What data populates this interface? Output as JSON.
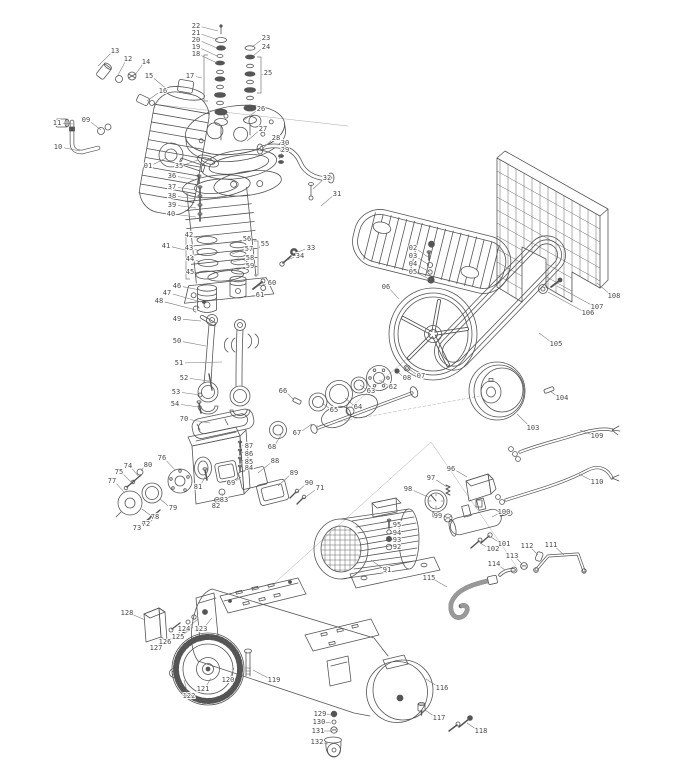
{
  "page": {
    "background": "#ffffff"
  },
  "diagram": {
    "type": "exploded-parts-diagram",
    "subject": "belt-drive air compressor: pump head, cylinder, pistons, crankcase, flywheel, belt, belt guard, motor, pressure switch, gauge, air tank, wheels",
    "style": {
      "line_color": "#555555",
      "label_color": "#4a4a4a",
      "leader_color": "#777777",
      "background": "#ffffff"
    },
    "label_range": "01-132",
    "components": [
      "air-filter-silencer",
      "valve-stacks",
      "cylinder-head",
      "exhaust-tube",
      "cooling-shroud",
      "cylinder",
      "piston-rings",
      "pistons",
      "connecting-rods",
      "crankcase",
      "bearing-covers",
      "crankshaft",
      "bearings",
      "flywheel",
      "drive-belt",
      "belt-guard",
      "motor-pulley",
      "electric-motor",
      "pressure-switch",
      "pressure-gauge",
      "outlet-manifold",
      "pipes",
      "hose",
      "wires",
      "air-tank",
      "wheel",
      "caster"
    ],
    "parts": [
      {
        "n": "01",
        "x": 148,
        "y": 166,
        "tx": 166,
        "ty": 158
      },
      {
        "n": "02",
        "x": 413,
        "y": 248,
        "tx": 428,
        "ty": 257
      },
      {
        "n": "03",
        "x": 413,
        "y": 256,
        "tx": 429,
        "ty": 265
      },
      {
        "n": "04",
        "x": 413,
        "y": 264,
        "tx": 430,
        "ty": 272
      },
      {
        "n": "05",
        "x": 413,
        "y": 272,
        "tx": 431,
        "ty": 280
      },
      {
        "n": "06",
        "x": 386,
        "y": 287,
        "tx": 399,
        "ty": 299
      },
      {
        "n": "07",
        "x": 421,
        "y": 376,
        "tx": 409,
        "ty": 369
      },
      {
        "n": "08",
        "x": 407,
        "y": 378,
        "tx": 398,
        "ty": 372
      },
      {
        "n": "09",
        "x": 86,
        "y": 120,
        "tx": 101,
        "ty": 130
      },
      {
        "n": "10",
        "x": 58,
        "y": 147,
        "tx": 80,
        "ty": 151
      },
      {
        "n": "11",
        "x": 57,
        "y": 123,
        "tx": 73,
        "ty": 124
      },
      {
        "n": "12",
        "x": 128,
        "y": 59,
        "tx": 117,
        "ty": 77
      },
      {
        "n": "13",
        "x": 115,
        "y": 51,
        "tx": 98,
        "ty": 66
      },
      {
        "n": "14",
        "x": 146,
        "y": 62,
        "tx": 135,
        "ty": 75
      },
      {
        "n": "15",
        "x": 149,
        "y": 76,
        "tx": 168,
        "ty": 90
      },
      {
        "n": "16",
        "x": 163,
        "y": 91,
        "tx": 147,
        "ty": 101
      },
      {
        "n": "17",
        "x": 190,
        "y": 76,
        "tx": 202,
        "ty": 78
      },
      {
        "n": "18",
        "x": 196,
        "y": 54,
        "tx": 217,
        "ty": 63
      },
      {
        "n": "19",
        "x": 196,
        "y": 47,
        "tx": 217,
        "ty": 56
      },
      {
        "n": "20",
        "x": 196,
        "y": 40,
        "tx": 217,
        "ty": 48
      },
      {
        "n": "21",
        "x": 196,
        "y": 33,
        "tx": 218,
        "ty": 40
      },
      {
        "n": "22",
        "x": 196,
        "y": 26,
        "tx": 218,
        "ty": 31
      },
      {
        "n": "23",
        "x": 266,
        "y": 38,
        "tx": 252,
        "ty": 47
      },
      {
        "n": "24",
        "x": 266,
        "y": 47,
        "tx": 253,
        "ty": 56
      },
      {
        "n": "25",
        "x": 268,
        "y": 73,
        "tx": 262,
        "ty": 75
      },
      {
        "n": "26",
        "x": 261,
        "y": 109,
        "tx": 244,
        "ty": 120
      },
      {
        "n": "27",
        "x": 263,
        "y": 129,
        "tx": 247,
        "ty": 141
      },
      {
        "n": "28",
        "x": 276,
        "y": 138,
        "tx": 261,
        "ty": 150
      },
      {
        "n": "29",
        "x": 285,
        "y": 150,
        "tx": 279,
        "ty": 159
      },
      {
        "n": "30",
        "x": 285,
        "y": 143,
        "tx": 280,
        "ty": 152
      },
      {
        "n": "31",
        "x": 337,
        "y": 194,
        "tx": 321,
        "ty": 206
      },
      {
        "n": "32",
        "x": 327,
        "y": 178,
        "tx": 313,
        "ty": 189
      },
      {
        "n": "33",
        "x": 311,
        "y": 248,
        "tx": 298,
        "ty": 252
      },
      {
        "n": "34",
        "x": 300,
        "y": 256,
        "tx": 287,
        "ty": 260
      },
      {
        "n": "35",
        "x": 179,
        "y": 166,
        "tx": 198,
        "ty": 160
      },
      {
        "n": "36",
        "x": 172,
        "y": 176,
        "tx": 196,
        "ty": 180
      },
      {
        "n": "37",
        "x": 172,
        "y": 187,
        "tx": 196,
        "ty": 190
      },
      {
        "n": "38",
        "x": 172,
        "y": 196,
        "tx": 196,
        "ty": 199
      },
      {
        "n": "39",
        "x": 172,
        "y": 205,
        "tx": 196,
        "ty": 208
      },
      {
        "n": "40",
        "x": 171,
        "y": 214,
        "tx": 196,
        "ty": 217
      },
      {
        "n": "41",
        "x": 166,
        "y": 246,
        "tx": 185,
        "ty": 250
      },
      {
        "n": "42",
        "x": 189,
        "y": 235,
        "tx": 199,
        "ty": 239
      },
      {
        "n": "43",
        "x": 189,
        "y": 248,
        "tx": 199,
        "ty": 251
      },
      {
        "n": "44",
        "x": 190,
        "y": 259,
        "tx": 200,
        "ty": 262
      },
      {
        "n": "45",
        "x": 190,
        "y": 272,
        "tx": 199,
        "ty": 274
      },
      {
        "n": "46",
        "x": 177,
        "y": 286,
        "tx": 200,
        "ty": 290
      },
      {
        "n": "47",
        "x": 167,
        "y": 293,
        "tx": 201,
        "ty": 302
      },
      {
        "n": "48",
        "x": 159,
        "y": 301,
        "tx": 196,
        "ty": 310
      },
      {
        "n": "49",
        "x": 177,
        "y": 319,
        "tx": 201,
        "ty": 321
      },
      {
        "n": "50",
        "x": 177,
        "y": 341,
        "tx": 206,
        "ty": 346
      },
      {
        "n": "51",
        "x": 179,
        "y": 363,
        "tx": 222,
        "ty": 362
      },
      {
        "n": "52",
        "x": 184,
        "y": 378,
        "tx": 209,
        "ty": 381
      },
      {
        "n": "53",
        "x": 176,
        "y": 392,
        "tx": 200,
        "ty": 395
      },
      {
        "n": "54",
        "x": 175,
        "y": 404,
        "tx": 199,
        "ty": 407
      },
      {
        "n": "55",
        "x": 265,
        "y": 244,
        "tx": 259,
        "ty": 248
      },
      {
        "n": "56",
        "x": 247,
        "y": 239,
        "tx": 231,
        "ty": 244
      },
      {
        "n": "57",
        "x": 249,
        "y": 249,
        "tx": 232,
        "ty": 254
      },
      {
        "n": "58",
        "x": 250,
        "y": 258,
        "tx": 233,
        "ty": 262
      },
      {
        "n": "59",
        "x": 250,
        "y": 266,
        "tx": 234,
        "ty": 271
      },
      {
        "n": "60",
        "x": 272,
        "y": 283,
        "tx": 259,
        "ty": 286
      },
      {
        "n": "61",
        "x": 260,
        "y": 295,
        "tx": 246,
        "ty": 297
      },
      {
        "n": "62",
        "x": 393,
        "y": 387,
        "tx": 379,
        "ty": 380
      },
      {
        "n": "63",
        "x": 371,
        "y": 391,
        "tx": 360,
        "ty": 385
      },
      {
        "n": "64",
        "x": 358,
        "y": 407,
        "tx": 345,
        "ty": 398
      },
      {
        "n": "65",
        "x": 334,
        "y": 410,
        "tx": 322,
        "ty": 403
      },
      {
        "n": "66",
        "x": 283,
        "y": 391,
        "tx": 294,
        "ty": 400
      },
      {
        "n": "67",
        "x": 297,
        "y": 433,
        "tx": 312,
        "ty": 424
      },
      {
        "n": "68",
        "x": 272,
        "y": 447,
        "tx": 281,
        "ty": 435
      },
      {
        "n": "69",
        "x": 231,
        "y": 483,
        "tx": 241,
        "ty": 477
      },
      {
        "n": "70",
        "x": 184,
        "y": 419,
        "tx": 210,
        "ty": 423
      },
      {
        "n": "71",
        "x": 320,
        "y": 488,
        "tx": 303,
        "ty": 499
      },
      {
        "n": "72",
        "x": 146,
        "y": 524,
        "tx": 158,
        "ty": 514
      },
      {
        "n": "73",
        "x": 137,
        "y": 528,
        "tx": 150,
        "ty": 519
      },
      {
        "n": "74",
        "x": 128,
        "y": 466,
        "tx": 139,
        "ty": 477
      },
      {
        "n": "75",
        "x": 119,
        "y": 472,
        "tx": 132,
        "ty": 483
      },
      {
        "n": "76",
        "x": 162,
        "y": 458,
        "tx": 175,
        "ty": 470
      },
      {
        "n": "77",
        "x": 112,
        "y": 481,
        "tx": 124,
        "ty": 492
      },
      {
        "n": "78",
        "x": 155,
        "y": 517,
        "tx": 142,
        "ty": 509
      },
      {
        "n": "79",
        "x": 173,
        "y": 508,
        "tx": 160,
        "ty": 499
      },
      {
        "n": "80",
        "x": 148,
        "y": 465,
        "tx": 141,
        "ty": 471
      },
      {
        "n": "81",
        "x": 198,
        "y": 487,
        "tx": 205,
        "ty": 477
      },
      {
        "n": "82",
        "x": 216,
        "y": 506,
        "tx": 217,
        "ty": 500
      },
      {
        "n": "83",
        "x": 224,
        "y": 500,
        "tx": 222,
        "ty": 493
      },
      {
        "n": "84",
        "x": 249,
        "y": 468,
        "tx": 242,
        "ty": 467
      },
      {
        "n": "85",
        "x": 249,
        "y": 462,
        "tx": 242,
        "ty": 460
      },
      {
        "n": "86",
        "x": 249,
        "y": 454,
        "tx": 242,
        "ty": 452
      },
      {
        "n": "87",
        "x": 249,
        "y": 446,
        "tx": 242,
        "ty": 445
      },
      {
        "n": "88",
        "x": 275,
        "y": 461,
        "tx": 258,
        "ty": 473
      },
      {
        "n": "89",
        "x": 294,
        "y": 473,
        "tx": 278,
        "ty": 486
      },
      {
        "n": "90",
        "x": 309,
        "y": 483,
        "tx": 296,
        "ty": 493
      },
      {
        "n": "91",
        "x": 387,
        "y": 570,
        "tx": 371,
        "ty": 560
      },
      {
        "n": "92",
        "x": 397,
        "y": 547,
        "tx": 391,
        "ty": 547
      },
      {
        "n": "93",
        "x": 397,
        "y": 540,
        "tx": 391,
        "ty": 539
      },
      {
        "n": "94",
        "x": 397,
        "y": 533,
        "tx": 391,
        "ty": 532
      },
      {
        "n": "95",
        "x": 397,
        "y": 525,
        "tx": 391,
        "ty": 524
      },
      {
        "n": "96",
        "x": 451,
        "y": 469,
        "tx": 467,
        "ty": 477
      },
      {
        "n": "97",
        "x": 431,
        "y": 478,
        "tx": 447,
        "ty": 487
      },
      {
        "n": "98",
        "x": 408,
        "y": 489,
        "tx": 428,
        "ty": 497
      },
      {
        "n": "99",
        "x": 438,
        "y": 516,
        "tx": 446,
        "ty": 517
      },
      {
        "n": "100",
        "x": 504,
        "y": 512,
        "tx": 492,
        "ty": 517
      },
      {
        "n": "101",
        "x": 504,
        "y": 544,
        "tx": 491,
        "ty": 537
      },
      {
        "n": "102",
        "x": 493,
        "y": 549,
        "tx": 480,
        "ty": 543
      },
      {
        "n": "103",
        "x": 533,
        "y": 428,
        "tx": 517,
        "ty": 414
      },
      {
        "n": "104",
        "x": 562,
        "y": 398,
        "tx": 550,
        "ty": 391
      },
      {
        "n": "105",
        "x": 556,
        "y": 344,
        "tx": 539,
        "ty": 333
      },
      {
        "n": "106",
        "x": 588,
        "y": 313,
        "tx": 548,
        "ty": 292
      },
      {
        "n": "107",
        "x": 597,
        "y": 307,
        "tx": 557,
        "ty": 286
      },
      {
        "n": "108",
        "x": 614,
        "y": 296,
        "tx": 597,
        "ty": 283
      },
      {
        "n": "109",
        "x": 597,
        "y": 436,
        "tx": 580,
        "ty": 430
      },
      {
        "n": "110",
        "x": 597,
        "y": 482,
        "tx": 579,
        "ty": 474
      },
      {
        "n": "111",
        "x": 551,
        "y": 545,
        "tx": 564,
        "ty": 555
      },
      {
        "n": "112",
        "x": 527,
        "y": 546,
        "tx": 538,
        "ty": 555
      },
      {
        "n": "113",
        "x": 512,
        "y": 556,
        "tx": 522,
        "ty": 564
      },
      {
        "n": "114",
        "x": 494,
        "y": 564,
        "tx": 505,
        "ty": 570
      },
      {
        "n": "115",
        "x": 429,
        "y": 578,
        "tx": 447,
        "ty": 587
      },
      {
        "n": "116",
        "x": 442,
        "y": 688,
        "tx": 426,
        "ty": 679
      },
      {
        "n": "117",
        "x": 439,
        "y": 718,
        "tx": 425,
        "ty": 710
      },
      {
        "n": "118",
        "x": 481,
        "y": 731,
        "tx": 467,
        "ty": 723
      },
      {
        "n": "119",
        "x": 274,
        "y": 680,
        "tx": 253,
        "ty": 670
      },
      {
        "n": "120",
        "x": 228,
        "y": 680,
        "tx": 234,
        "ty": 668
      },
      {
        "n": "121",
        "x": 203,
        "y": 689,
        "tx": 211,
        "ty": 678
      },
      {
        "n": "122",
        "x": 189,
        "y": 696,
        "tx": 184,
        "ty": 680
      },
      {
        "n": "123",
        "x": 201,
        "y": 629,
        "tx": 212,
        "ty": 618
      },
      {
        "n": "124",
        "x": 184,
        "y": 629,
        "tx": 198,
        "ty": 619
      },
      {
        "n": "125",
        "x": 178,
        "y": 637,
        "tx": 193,
        "ty": 627
      },
      {
        "n": "126",
        "x": 165,
        "y": 642,
        "tx": 180,
        "ty": 632
      },
      {
        "n": "127",
        "x": 156,
        "y": 648,
        "tx": 171,
        "ty": 638
      },
      {
        "n": "128",
        "x": 127,
        "y": 613,
        "tx": 145,
        "ty": 620
      },
      {
        "n": "129",
        "x": 320,
        "y": 714,
        "tx": 331,
        "ty": 715
      },
      {
        "n": "130",
        "x": 319,
        "y": 722,
        "tx": 331,
        "ty": 723
      },
      {
        "n": "131",
        "x": 318,
        "y": 731,
        "tx": 331,
        "ty": 731
      },
      {
        "n": "132",
        "x": 317,
        "y": 742,
        "tx": 328,
        "ty": 744
      }
    ],
    "group_brackets": [
      {
        "for": "17",
        "x": 204,
        "y1": 55,
        "y2": 101,
        "arm": 4
      },
      {
        "for": "25",
        "x": 261,
        "y1": 57,
        "y2": 93,
        "arm": -4
      },
      {
        "for": "41",
        "x": 186,
        "y1": 235,
        "y2": 279,
        "arm": 4
      },
      {
        "for": "55",
        "x": 258,
        "y1": 241,
        "y2": 275,
        "arm": -4
      }
    ]
  }
}
